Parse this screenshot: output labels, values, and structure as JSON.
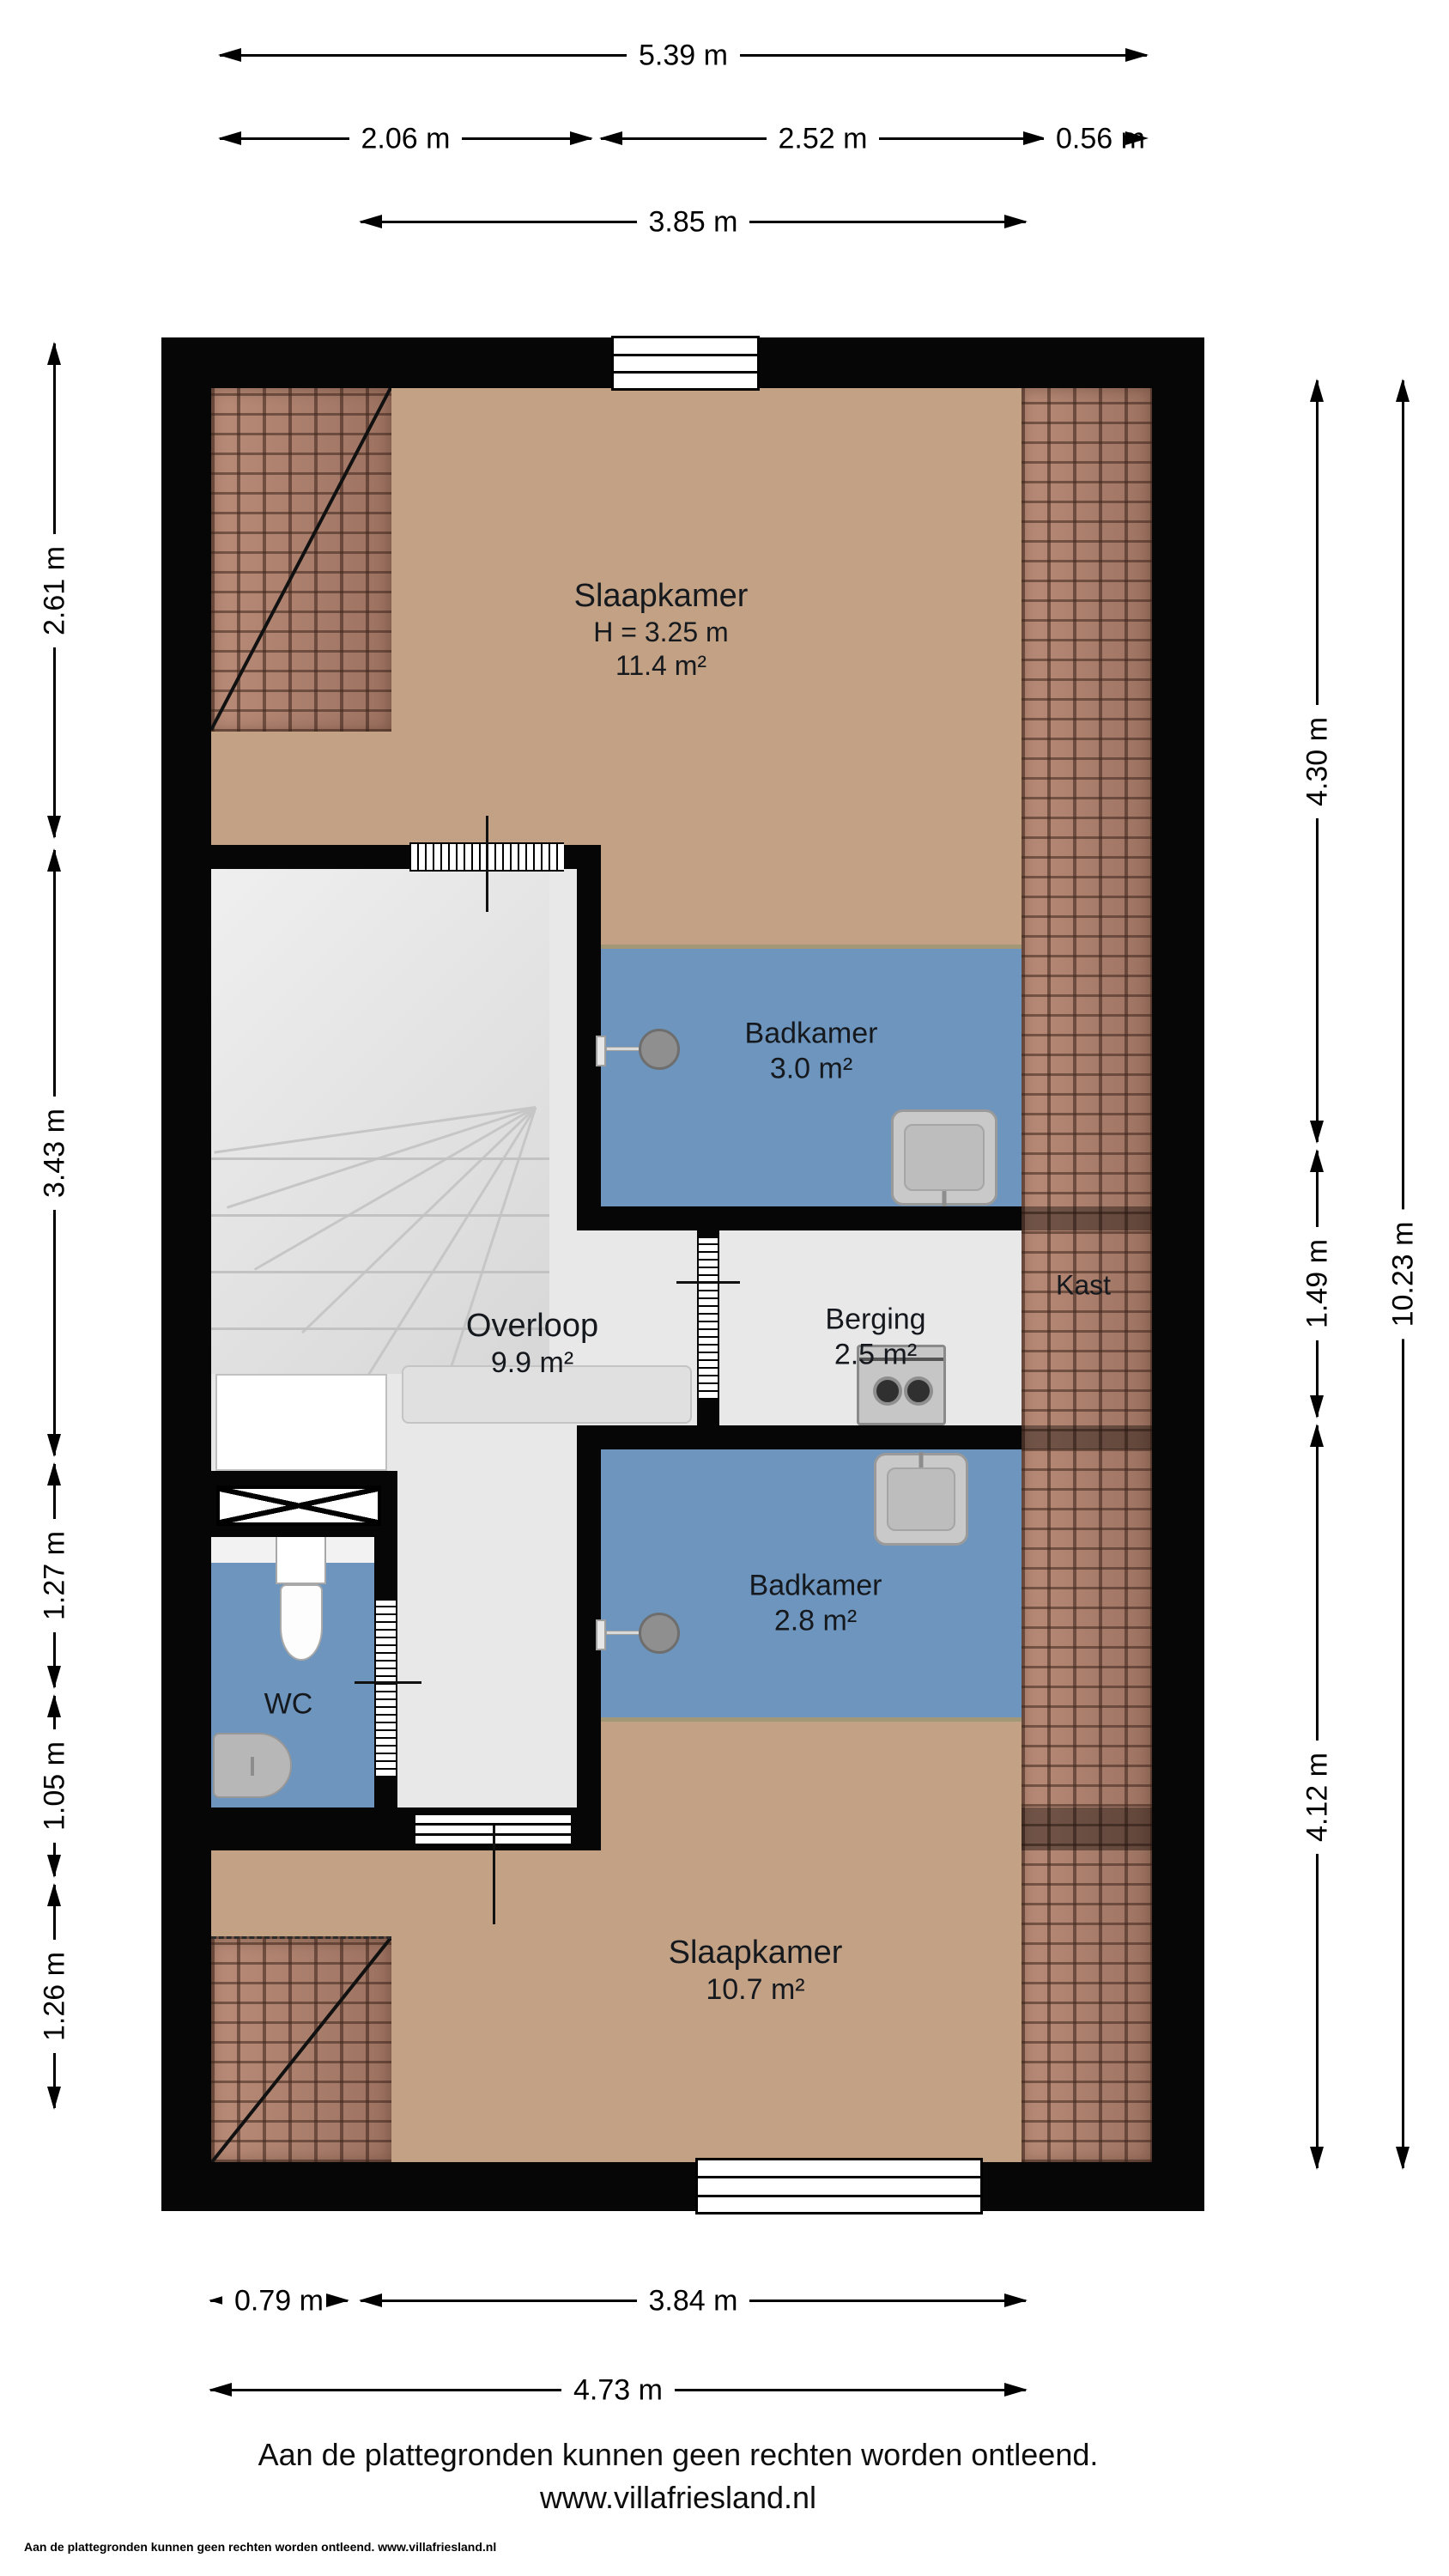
{
  "title": "Floor plan - second floor (verdieping)",
  "rooms": {
    "slaapkamer_top": {
      "name": "Slaapkamer",
      "height": "H = 3.25 m",
      "area": "11.4 m²"
    },
    "badkamer_top": {
      "name": "Badkamer",
      "area": "3.0 m²"
    },
    "overloop": {
      "name": "Overloop",
      "area": "9.9 m²"
    },
    "berging": {
      "name": "Berging",
      "area": "2.5 m²"
    },
    "kast": {
      "name": "Kast"
    },
    "badkamer_bottom": {
      "name": "Badkamer",
      "area": "2.8 m²"
    },
    "wc": {
      "name": "WC"
    },
    "slaapkamer_bottom": {
      "name": "Slaapkamer",
      "area": "10.7 m²"
    }
  },
  "dims": {
    "top": [
      "5.39 m",
      "2.06 m",
      "2.52 m",
      "0.56 m",
      "3.85 m"
    ],
    "left": [
      "2.61 m",
      "3.43 m",
      "1.27 m",
      "1.05 m",
      "1.26 m"
    ],
    "right": [
      "4.30 m",
      "1.49 m",
      "4.12 m",
      "10.23 m"
    ],
    "bottom": [
      "0.79 m",
      "3.84 m",
      "4.73 m"
    ]
  },
  "footer": {
    "disclaimer": "Aan de plattegronden kunnen geen rechten worden ontleend.",
    "website": "www.villafriesland.nl",
    "watermark": "Aan de plattegronden kunnen geen rechten worden ontleend. www.villafriesland.nl"
  },
  "icons": {
    "shower": "shower-head-icon",
    "sink": "washbasin-icon",
    "toilet": "toilet-icon",
    "washer": "washing-machine-icon",
    "stairs": "winder-staircase-icon",
    "skylight": "cross-hatch-skylight-icon",
    "roof": "roof-tiles-texture"
  },
  "colors": {
    "wall": "#060606",
    "floor_bedroom": "#c2a185",
    "floor_wet_room": "#6d95bd",
    "floor_hall": "#e8e8e8",
    "roof_tiles": "#a87f6d",
    "background": "#ffffff"
  }
}
